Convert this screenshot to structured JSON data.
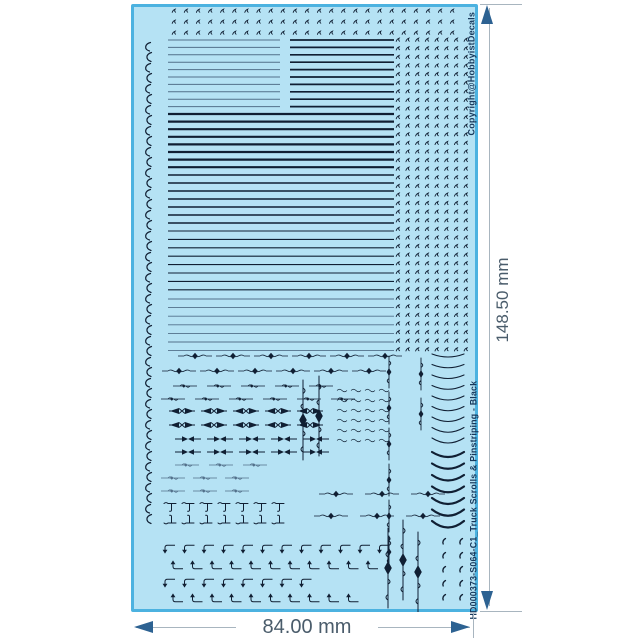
{
  "colors": {
    "page_bg": "#ffffff",
    "sheet_fill": "#b5e2f4",
    "sheet_border": "#4cb2e0",
    "ink": "#101f33",
    "ink_light": "#52708a",
    "label_text": "#17395c",
    "dim_line": "#a8b5bf",
    "dim_arrow": "#2d6292",
    "dim_text": "#4a5c6b"
  },
  "sheet": {
    "copyright_text": "Copyright@HobbyistDecals",
    "id_text": "HD000373-S064-C1_Truck Scrolls & Pinstriping - Black"
  },
  "dimensions": {
    "width_label": "84.00 mm",
    "height_label": "148.50 mm"
  },
  "artwork": {
    "elements": [
      {
        "type": "tick-row",
        "x": 41,
        "y": 5,
        "count": 24,
        "dx": 12.1
      },
      {
        "type": "tick-row",
        "x": 41,
        "y": 16,
        "count": 24,
        "dx": 12.1
      },
      {
        "type": "tick-row",
        "x": 41,
        "y": 27,
        "count": 24,
        "dx": 12.1
      },
      {
        "type": "curl-col",
        "x": 11,
        "y": 38,
        "count": 23,
        "dy": 21
      },
      {
        "type": "stripes",
        "x": 37,
        "y": 36,
        "len": 112,
        "count": 10,
        "dy": 7.4,
        "t": 1,
        "light": true
      },
      {
        "type": "stripes",
        "x": 159,
        "y": 36,
        "len": 104,
        "count": 10,
        "dy": 7.4,
        "t": 1.7
      },
      {
        "type": "stripes",
        "x": 37,
        "y": 110,
        "len": 226,
        "count": 8,
        "dy": 7.6,
        "t": 2.2
      },
      {
        "type": "stripes",
        "x": 37,
        "y": 171,
        "len": 226,
        "count": 7,
        "dy": 8,
        "t": 1.5
      },
      {
        "type": "stripes",
        "x": 37,
        "y": 227,
        "len": 226,
        "count": 8,
        "dy": 8.4,
        "t": 1.1
      },
      {
        "type": "stripes",
        "x": 37,
        "y": 295,
        "len": 226,
        "count": 7,
        "dy": 8.6,
        "t": 0.9,
        "light": true
      },
      {
        "type": "tick-grid",
        "x": 265,
        "y": 34,
        "cols": 8,
        "rows": 37,
        "dx": 9.7,
        "dy": 8.6
      },
      {
        "type": "row",
        "glyph": "hscroll",
        "x": 47,
        "y": 348,
        "count": 6,
        "dx": 38
      },
      {
        "type": "row",
        "glyph": "hscroll",
        "x": 31,
        "y": 363,
        "count": 6,
        "dx": 38
      },
      {
        "type": "row",
        "glyph": "scrollsm",
        "x": 42,
        "y": 379,
        "count": 5,
        "dx": 34
      },
      {
        "type": "row",
        "glyph": "scrollsm",
        "x": 30,
        "y": 392,
        "count": 6,
        "dx": 34
      },
      {
        "type": "row",
        "glyph": "bowtie",
        "x": 38,
        "y": 403,
        "count": 5,
        "dx": 32
      },
      {
        "type": "row",
        "glyph": "bowtie",
        "x": 38,
        "y": 417,
        "count": 5,
        "dx": 32
      },
      {
        "type": "row",
        "glyph": "arrowbt",
        "x": 44,
        "y": 431,
        "count": 5,
        "dx": 32
      },
      {
        "type": "row",
        "glyph": "arrowbt",
        "x": 44,
        "y": 444,
        "count": 5,
        "dx": 32
      },
      {
        "type": "row",
        "glyph": "scrollsm",
        "x": 44,
        "y": 458,
        "count": 3,
        "dx": 34,
        "light": true
      },
      {
        "type": "row",
        "glyph": "scrollsm",
        "x": 30,
        "y": 471,
        "count": 3,
        "dx": 32,
        "light": true
      },
      {
        "type": "row",
        "glyph": "scrollsm",
        "x": 30,
        "y": 484,
        "count": 3,
        "dx": 32,
        "light": true
      },
      {
        "type": "row",
        "glyph": "tmark",
        "x": 32,
        "y": 497,
        "count": 7,
        "dx": 18
      },
      {
        "type": "row",
        "glyph": "tmark2",
        "x": 32,
        "y": 511,
        "count": 7,
        "dx": 18
      },
      {
        "type": "row",
        "glyph": "hscroll",
        "x": 188,
        "y": 486,
        "count": 3,
        "dx": 46
      },
      {
        "type": "row",
        "glyph": "hscroll",
        "x": 183,
        "y": 508,
        "count": 3,
        "dx": 46
      },
      {
        "type": "dash-grid",
        "x": 206,
        "y": 384,
        "cols": 4,
        "rows": 6,
        "dx": 14,
        "dy": 10
      },
      {
        "type": "item",
        "glyph": "vscroll-lg",
        "x": 166,
        "y": 376
      },
      {
        "type": "item",
        "glyph": "vscroll-lg",
        "x": 182,
        "y": 372
      },
      {
        "type": "chain",
        "glyph": "vscroll",
        "x": 253,
        "y": 352,
        "count": 6,
        "dy": 36
      },
      {
        "type": "item",
        "glyph": "vscroll",
        "x": 285,
        "y": 354
      },
      {
        "type": "item",
        "glyph": "vscroll",
        "x": 285,
        "y": 394
      },
      {
        "type": "item",
        "glyph": "vscroll-lg",
        "x": 251,
        "y": 524
      },
      {
        "type": "item",
        "glyph": "vscroll-lg",
        "x": 266,
        "y": 516
      },
      {
        "type": "item",
        "glyph": "vscroll-lg",
        "x": 281,
        "y": 528
      },
      {
        "type": "arc-col",
        "x": 301,
        "y": 350,
        "count": 9,
        "dy": 10.5,
        "t": 1.1,
        "w": 32,
        "depth": 6
      },
      {
        "type": "arc-col",
        "x": 301,
        "y": 448,
        "count": 7,
        "dy": 11.5,
        "t": 2.2,
        "w": 32,
        "depth": 10
      },
      {
        "type": "comma-grid",
        "x": 310,
        "y": 534,
        "cols": 2,
        "rows": 5,
        "dx": 17,
        "dy": 14
      },
      {
        "type": "row",
        "glyph": "corner1",
        "x": 32,
        "y": 540,
        "count": 12,
        "dx": 19.5
      },
      {
        "type": "row",
        "glyph": "corner2",
        "x": 40,
        "y": 557,
        "count": 11,
        "dx": 19.5
      },
      {
        "type": "row",
        "glyph": "corner1",
        "x": 32,
        "y": 574,
        "count": 8,
        "dx": 19.5
      },
      {
        "type": "row",
        "glyph": "corner2",
        "x": 40,
        "y": 590,
        "count": 10,
        "dx": 19.5
      }
    ]
  }
}
